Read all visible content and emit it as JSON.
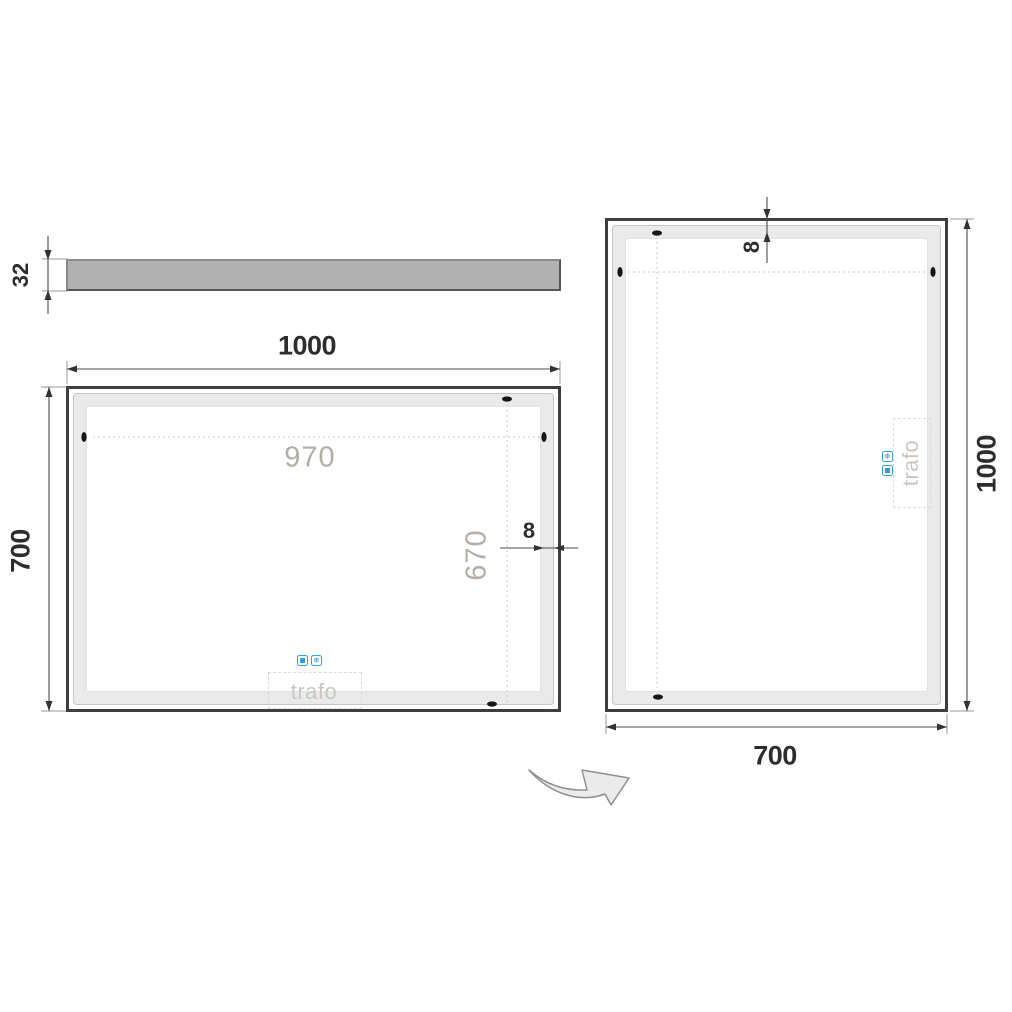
{
  "side_profile": {
    "thickness_label": "32"
  },
  "front_view": {
    "width_label": "1000",
    "height_label": "700",
    "led_width_label": "970",
    "led_height_label": "670",
    "edge_offset_label": "8",
    "trafo_label": "trafo"
  },
  "rotated_view": {
    "width_label": "700",
    "height_label": "1000",
    "edge_offset_label": "8",
    "trafo_label": "trafo"
  },
  "icons": {
    "touch_sensor": "square-in-square",
    "antifog": "snowflake",
    "antifog_glyph": "❄"
  },
  "colors": {
    "accent_blue": "#2f9fd8",
    "dimension_text": "#2d2d2d",
    "ghost_text": "#b4aea8",
    "trafo_text": "#cbc6c1",
    "frame": "#3e3e3e",
    "led_band": "#eaeaea",
    "profile_fill": "#b1b1b1",
    "rotation_arrow_fill": "#ebebeb"
  }
}
